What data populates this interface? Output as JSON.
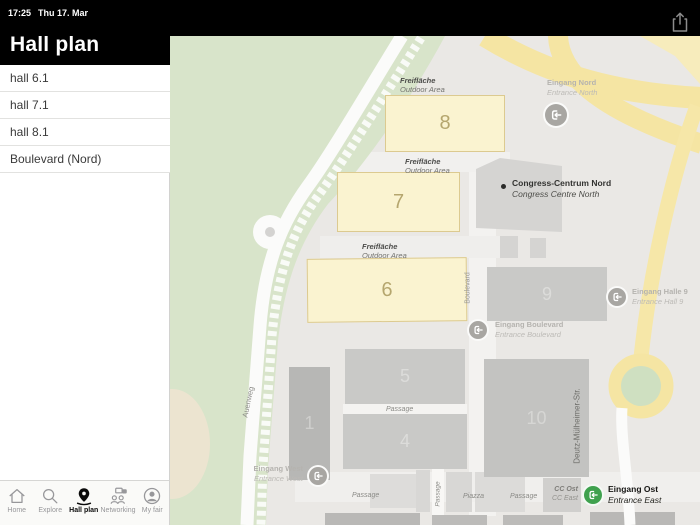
{
  "status_bar": {
    "time": "17:25",
    "date": "Thu 17. Mar"
  },
  "header": {
    "title": "Hall plan",
    "share_icon": "share-icon"
  },
  "sidebar": {
    "items": [
      {
        "label": "hall 6.1"
      },
      {
        "label": "hall 7.1"
      },
      {
        "label": "hall 8.1"
      },
      {
        "label": "Boulevard (Nord)"
      }
    ]
  },
  "tab_bar": {
    "active": "Hall plan",
    "tabs": [
      {
        "label": "Home",
        "icon": "home-icon"
      },
      {
        "label": "Explore",
        "icon": "search-icon"
      },
      {
        "label": "Hall plan",
        "icon": "map-pin-icon"
      },
      {
        "label": "Networking",
        "icon": "networking-icon"
      },
      {
        "label": "My fair",
        "icon": "person-icon"
      }
    ]
  },
  "map": {
    "halls": {
      "h8": "8",
      "h7": "7",
      "h6": "6",
      "h9": "9",
      "h5": "5",
      "h1": "1",
      "h4": "4",
      "h10": "10"
    },
    "outdoor": {
      "de": "Freifläche",
      "en": "Outdoor Area"
    },
    "entrances": {
      "nord": {
        "de": "Eingang Nord",
        "en": "Entrance North"
      },
      "halle9": {
        "de": "Eingang Halle 9",
        "en": "Entrance Hall 9"
      },
      "boulevard": {
        "de": "Eingang Boulevard",
        "en": "Entrance Boulevard"
      },
      "west": {
        "de": "Eingang West",
        "en": "Entrance West"
      },
      "ost": {
        "de": "Eingang Ost",
        "en": "Entrance East"
      }
    },
    "congress": {
      "de": "Congress-Centrum Nord",
      "en": "Congress Centre North"
    },
    "cc": {
      "de": "CC Ost",
      "en": "CC East"
    },
    "streets": {
      "auenweg": "Auenweg",
      "boulevard": "Boulevard",
      "deutz": "Deutz-Mülheimer-Str."
    },
    "passages": [
      "Passage",
      "Passage",
      "Passage",
      "Passage"
    ],
    "piazza": "Piazza",
    "colors": {
      "hall_outdoor_fill": "#faf3d0",
      "hall_indoor_fill": "#c9c9c7",
      "road_yellow": "#f5e5a3",
      "green_area": "#d8e4ca",
      "entrance_gray": "#a8a6a2",
      "entrance_green": "#3fa14e"
    }
  }
}
